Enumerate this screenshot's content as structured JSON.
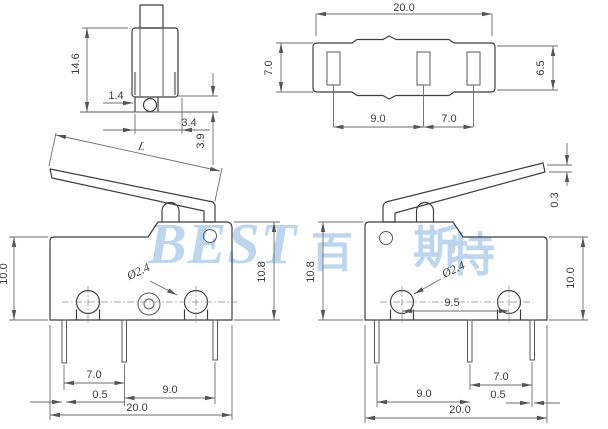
{
  "drawing": {
    "watermark": {
      "latin": "BEST",
      "cjk_1": "百",
      "cjk_2": "斯",
      "cjk_3": "特",
      "color": "#bdd6ee"
    },
    "side_view": {
      "overall_height": "14.6",
      "pivot_offset": "1.4",
      "button_offset": "3.4",
      "base_height": "3.9"
    },
    "top_view": {
      "overall_width": "20.0",
      "body_depth": "7.0",
      "inner_depth": "6.5",
      "terminal_pitch_left": "9.0",
      "terminal_pitch_right": "7.0"
    },
    "lever_view": {
      "lever_length": "L",
      "lever_tip_thickness": "0.3"
    },
    "front_view_left": {
      "body_height": "10.0",
      "overall_height": "10.8",
      "hole_diameter": "Ø2.4",
      "pin_pitch_left": "7.0",
      "pin_width": "0.5",
      "pin_pitch_right": "9.0",
      "overall_width": "20.0"
    },
    "front_view_right": {
      "overall_height": "10.8",
      "body_height": "10.0",
      "hole_diameter": "Ø2.4",
      "hole_pitch": "9.5",
      "pin_pitch_left": "9.0",
      "pin_pitch_right": "7.0",
      "pin_width": "0.5",
      "overall_width": "20.0"
    }
  }
}
